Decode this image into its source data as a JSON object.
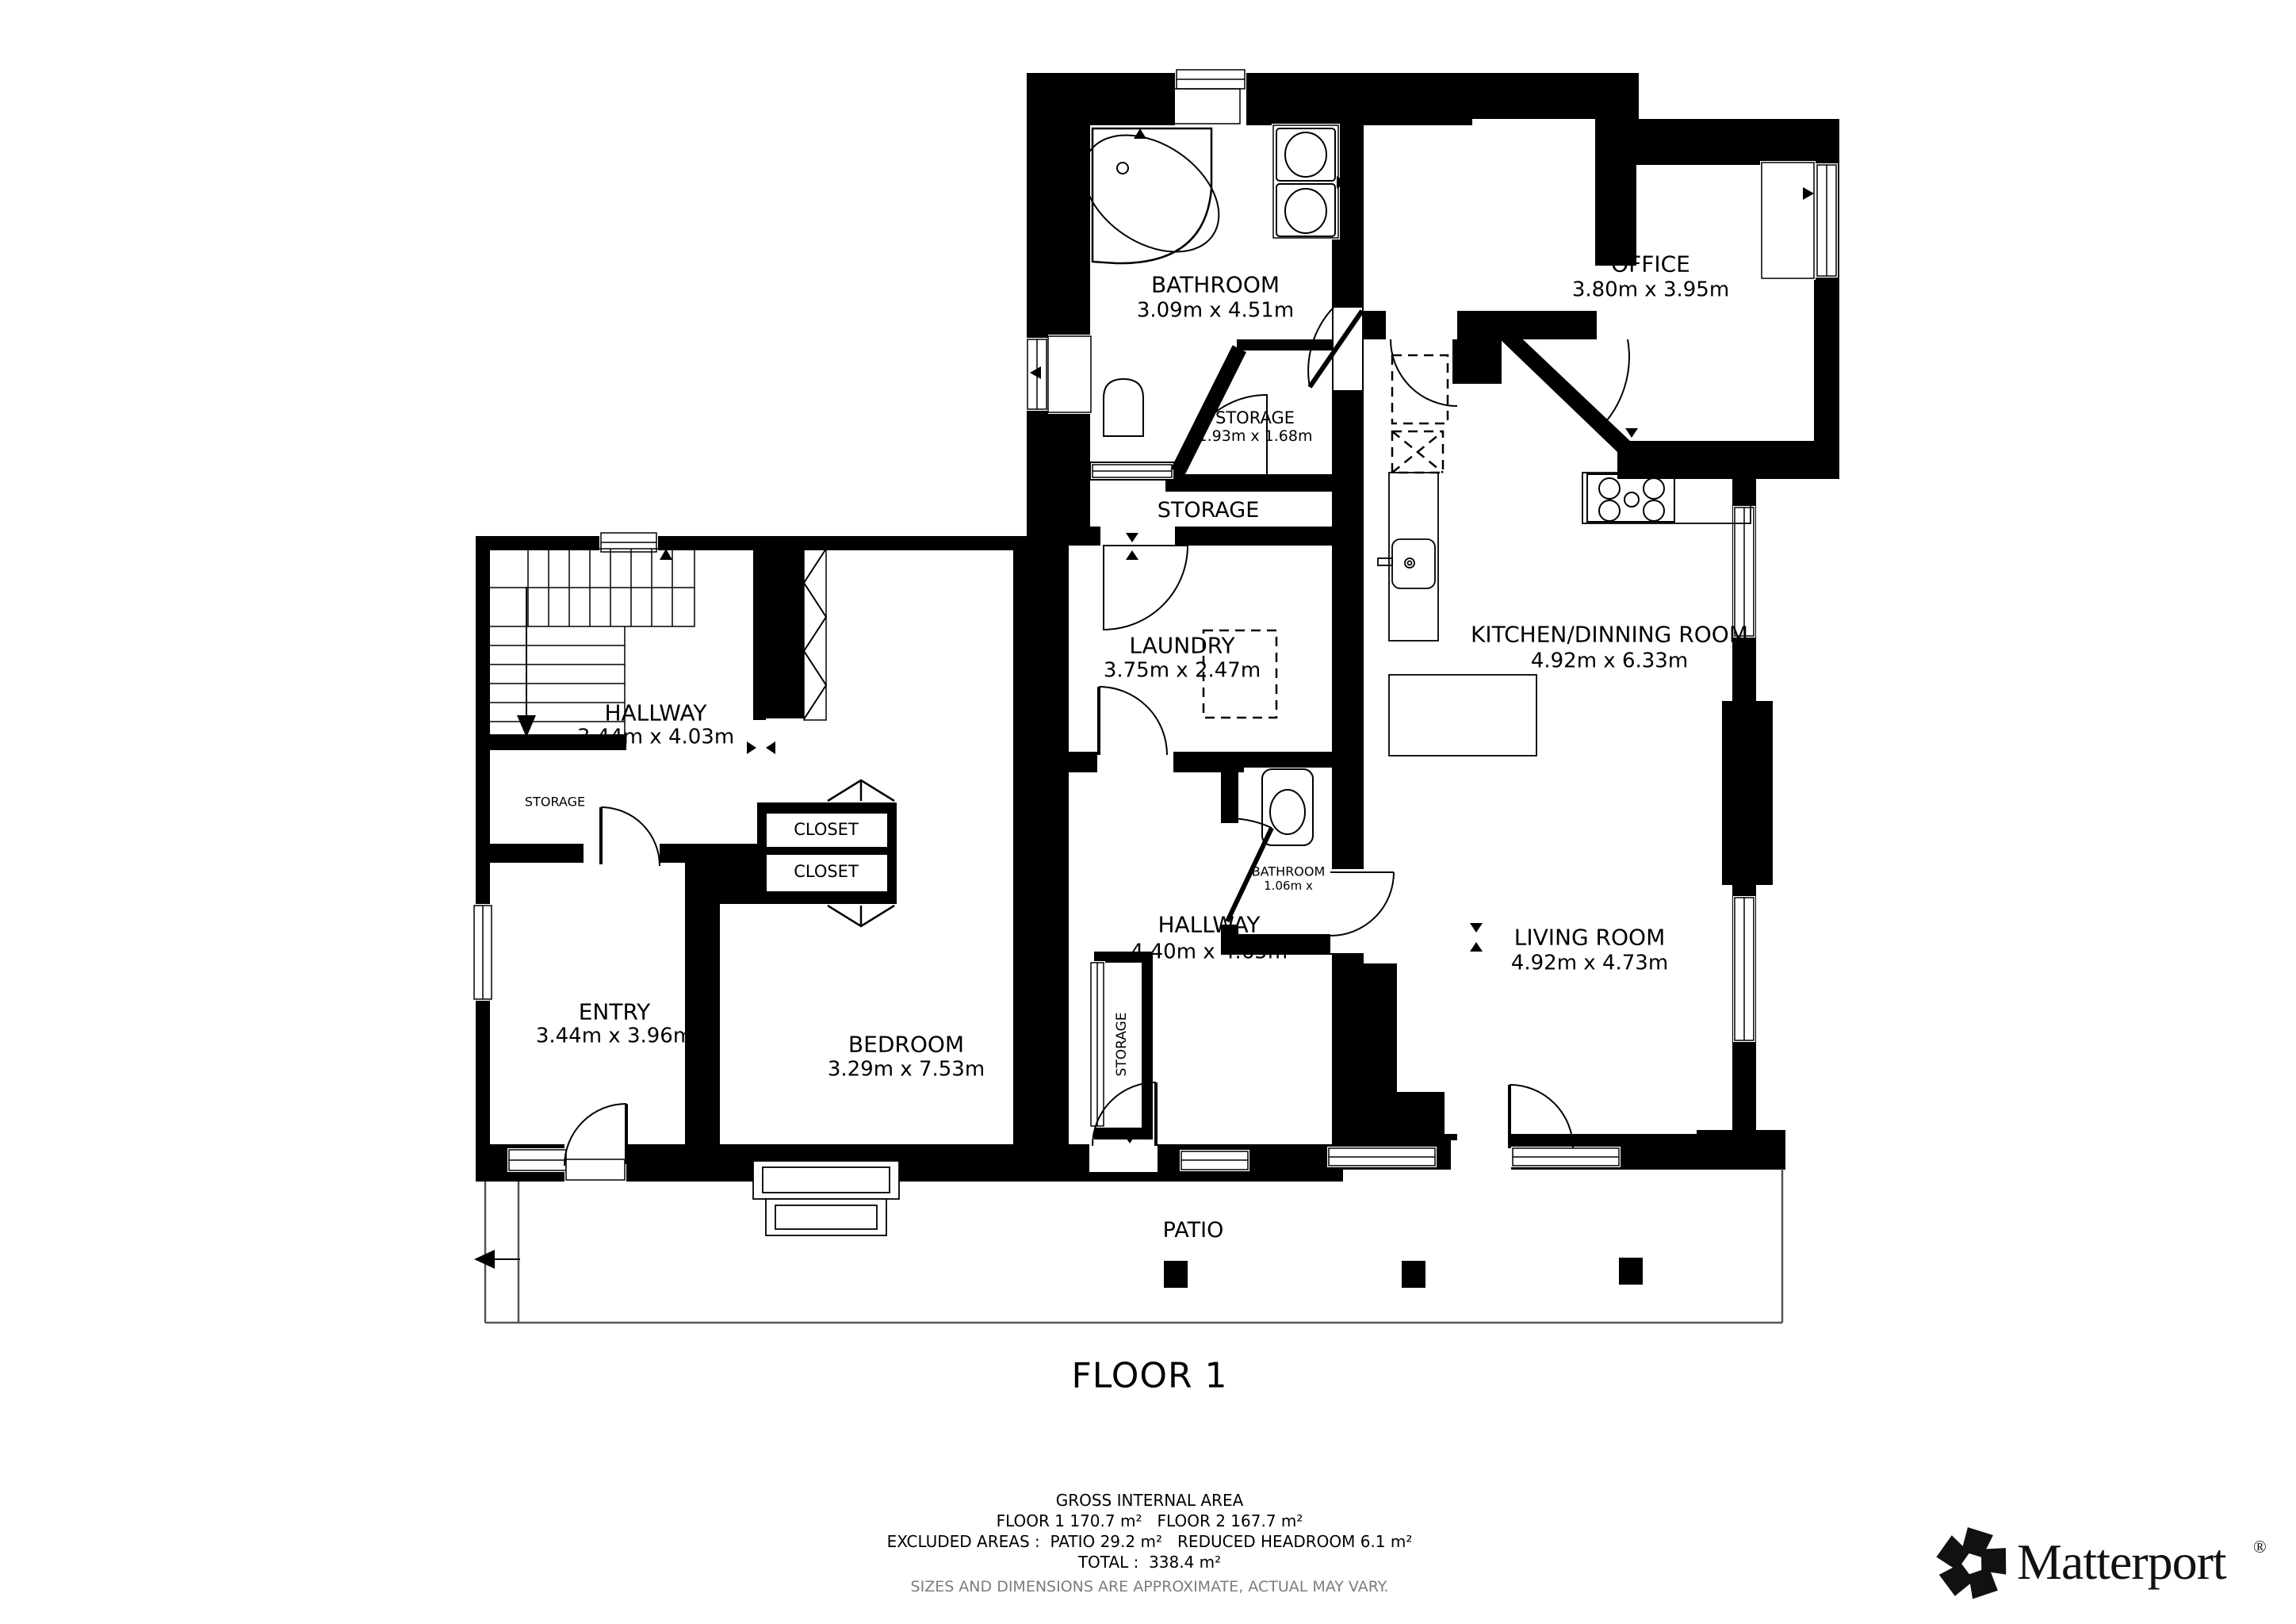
{
  "floor": {
    "title": "FLOOR 1"
  },
  "rooms": {
    "bathroom_main": {
      "name": "BATHROOM",
      "dims": "3.09m x 4.51m"
    },
    "storage_small_top": {
      "name": "STORAGE",
      "dims": "1.93m x 1.68m"
    },
    "storage_corridor": {
      "name": "STORAGE"
    },
    "office": {
      "name": "OFFICE",
      "dims": "3.80m x 3.95m"
    },
    "kitchen": {
      "name": "KITCHEN/DINNING ROOM",
      "dims": "4.92m x 6.33m"
    },
    "laundry": {
      "name": "LAUNDRY",
      "dims": "3.75m x 2.47m"
    },
    "bathroom_small": {
      "name": "BATHROOM",
      "dims": "1.06m x"
    },
    "hallway_center": {
      "name": "HALLWAY",
      "dims": "4.40m x 4.65m"
    },
    "storage_hall_closet": {
      "name": "STORAGE"
    },
    "living": {
      "name": "LIVING ROOM",
      "dims": "4.92m x 4.73m"
    },
    "hallway_left": {
      "name": "HALLWAY",
      "dims": "3.44m x 4.03m"
    },
    "storage_under_stairs": {
      "name": "STORAGE"
    },
    "entry": {
      "name": "ENTRY",
      "dims": "3.44m x 3.96m"
    },
    "bedroom": {
      "name": "BEDROOM",
      "dims": "3.29m x 7.53m"
    },
    "closet_1": {
      "name": "CLOSET"
    },
    "closet_2": {
      "name": "CLOSET"
    },
    "patio": {
      "name": "PATIO"
    }
  },
  "footer": {
    "line1": "GROSS INTERNAL AREA",
    "line2": "FLOOR 1 170.7 m²   FLOOR 2 167.7 m²",
    "line3": "EXCLUDED AREAS :  PATIO 29.2 m²   REDUCED HEADROOM 6.1 m²",
    "line4": "TOTAL :  338.4 m²",
    "disclaimer": "SIZES AND DIMENSIONS ARE APPROXIMATE, ACTUAL MAY VARY."
  },
  "brand": {
    "name": "Matterport",
    "registered": "®"
  }
}
